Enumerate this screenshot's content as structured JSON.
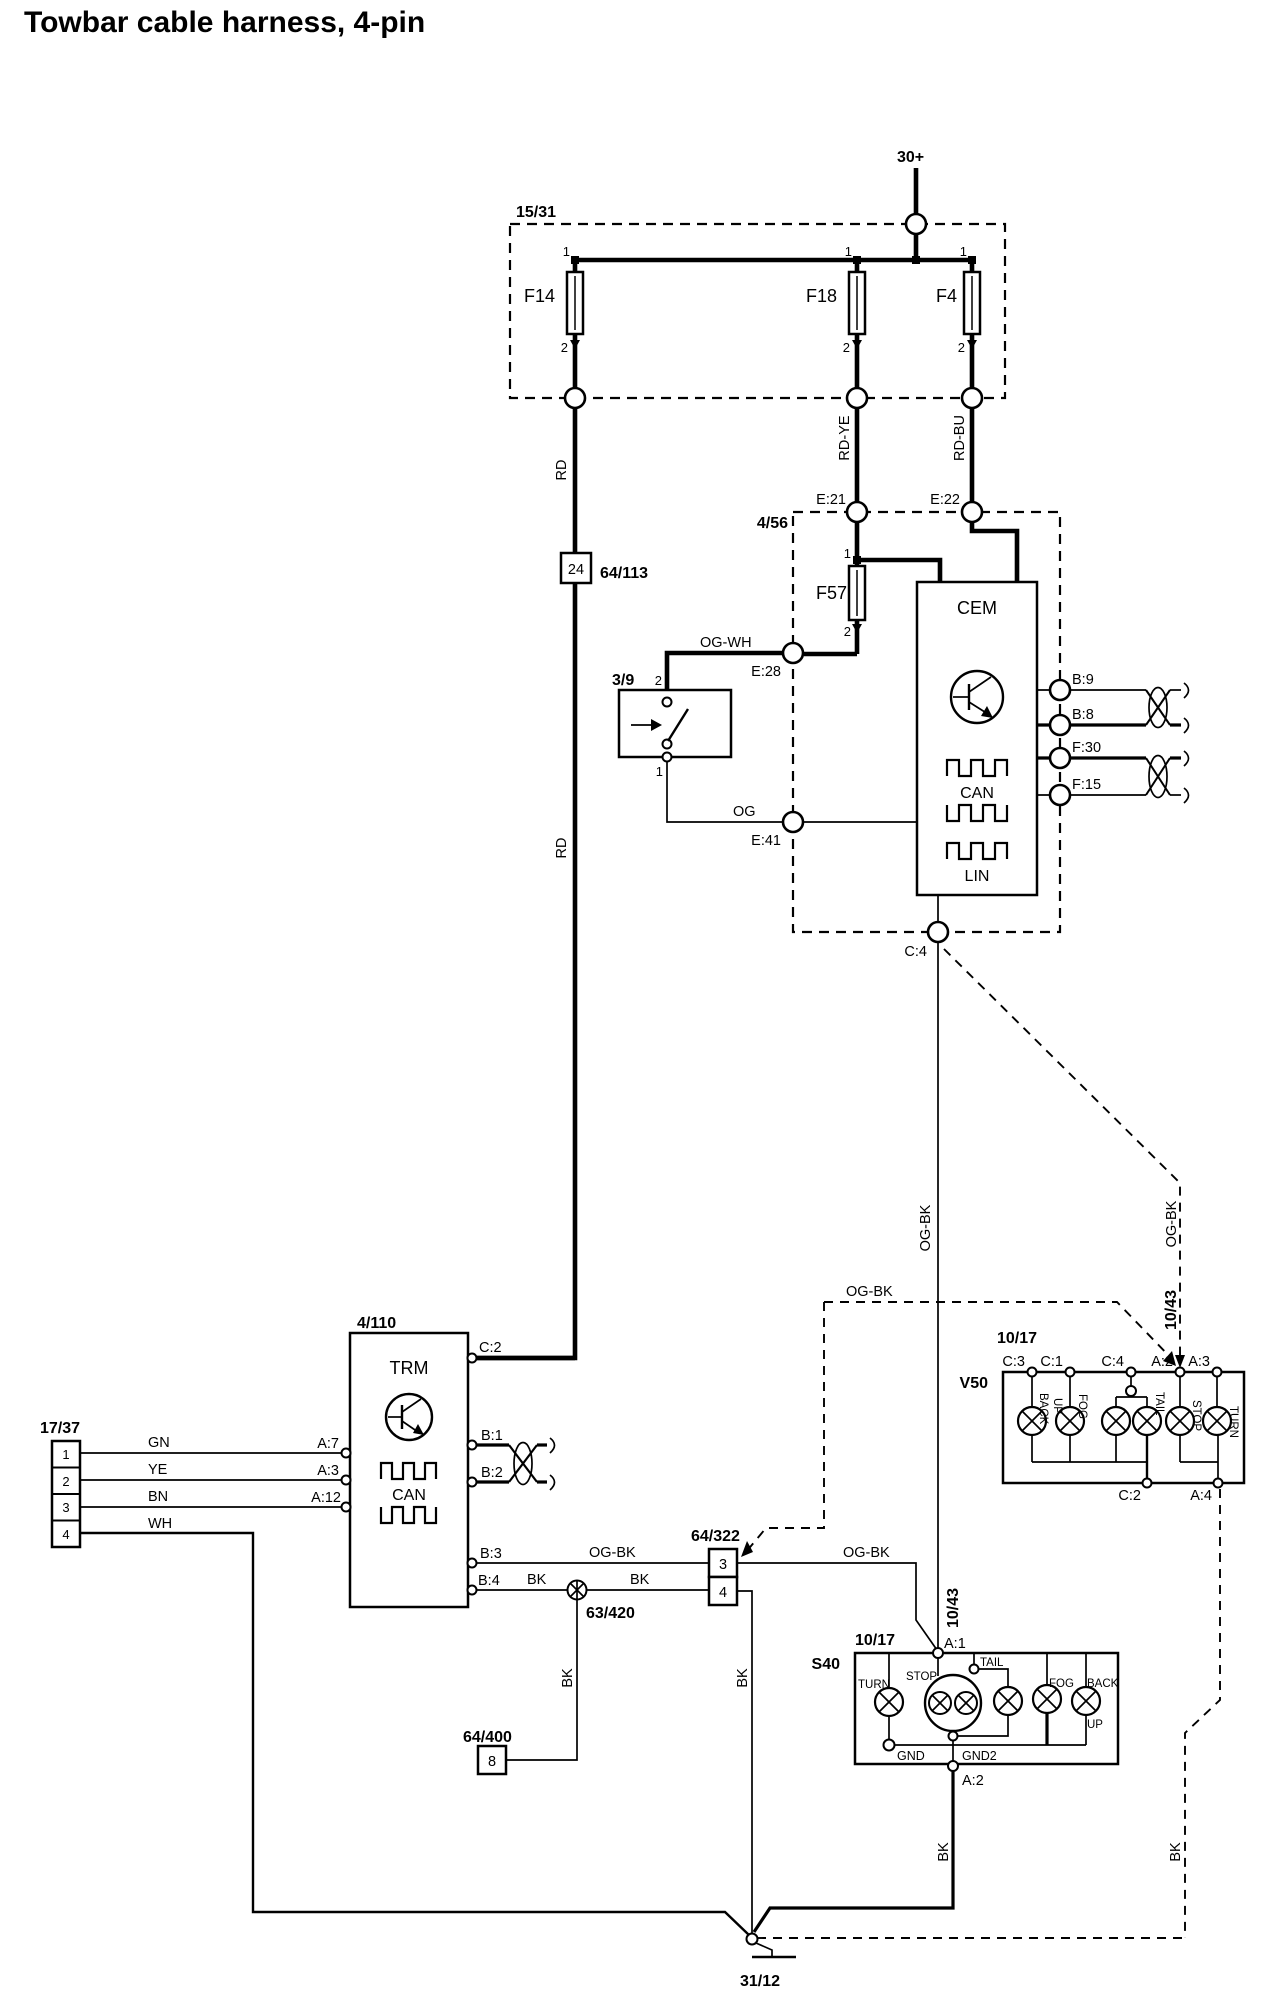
{
  "title": "Towbar cable harness, 4-pin",
  "power": {
    "supply": "30+"
  },
  "fusebox": {
    "id": "15/31",
    "fuses": {
      "f14": "F14",
      "f18": "F18",
      "f4": "F4"
    },
    "pin_top": "1",
    "pin_bottom": "2"
  },
  "wire_colors": {
    "rd": "RD",
    "rd_ye": "RD-YE",
    "rd_bu": "RD-BU",
    "og_wh": "OG-WH",
    "og": "OG",
    "og_bk": "OG-BK",
    "bk": "BK",
    "gn": "GN",
    "ye": "YE",
    "bn": "BN",
    "wh": "WH"
  },
  "cem": {
    "box_id": "4/56",
    "name": "CEM",
    "fuse": "F57",
    "fuse_pin_top": "1",
    "fuse_pin_bottom": "2",
    "bus_can": "CAN",
    "bus_lin": "LIN",
    "pins": {
      "e21": "E:21",
      "e22": "E:22",
      "e28": "E:28",
      "e41": "E:41",
      "c4": "C:4",
      "b9": "B:9",
      "b8": "B:8",
      "f30": "F:30",
      "f15": "F:15"
    }
  },
  "relay_switch": {
    "id": "3/9",
    "pin_top": "2",
    "pin_bottom": "1"
  },
  "connector_64_113": {
    "id": "64/113",
    "pin": "24"
  },
  "trm": {
    "box_id": "4/110",
    "name": "TRM",
    "bus_can": "CAN",
    "pins": {
      "c2": "C:2",
      "a7": "A:7",
      "a3": "A:3",
      "a12": "A:12",
      "b1": "B:1",
      "b2": "B:2",
      "b3": "B:3",
      "b4": "B:4"
    }
  },
  "connector_17_37": {
    "id": "17/37",
    "pins": [
      "1",
      "2",
      "3",
      "4"
    ]
  },
  "connector_64_322": {
    "id": "64/322",
    "pin3": "3",
    "pin4": "4"
  },
  "splice_63_420": {
    "id": "63/420"
  },
  "connector_64_400": {
    "id": "64/400",
    "pin": "8"
  },
  "v50_rear_lights": {
    "id": "10/17",
    "name": "V50",
    "pins_top": {
      "c3": "C:3",
      "c1": "C:1",
      "c4": "C:4",
      "a2": "A:2",
      "a3": "A:3"
    },
    "pins_bottom": {
      "c2": "C:2",
      "a4": "A:4"
    },
    "lamps": {
      "back": "BACK",
      "up": "UP",
      "fog": "FOG",
      "tail": "TAIL",
      "stop": "STOP",
      "turn": "TURN"
    }
  },
  "s40_rear_lights": {
    "id": "10/17",
    "name": "S40",
    "pins": {
      "a1": "A:1",
      "a2": "A:2"
    },
    "grounds": {
      "gnd": "GND",
      "gnd2": "GND2"
    },
    "lamps": {
      "turn": "TURN",
      "stop": "STOP",
      "tail": "TAIL",
      "fog": "FOG",
      "back": "BACK",
      "up": "UP"
    }
  },
  "harness_route": {
    "id": "10/43"
  },
  "ground": {
    "id": "31/12"
  }
}
